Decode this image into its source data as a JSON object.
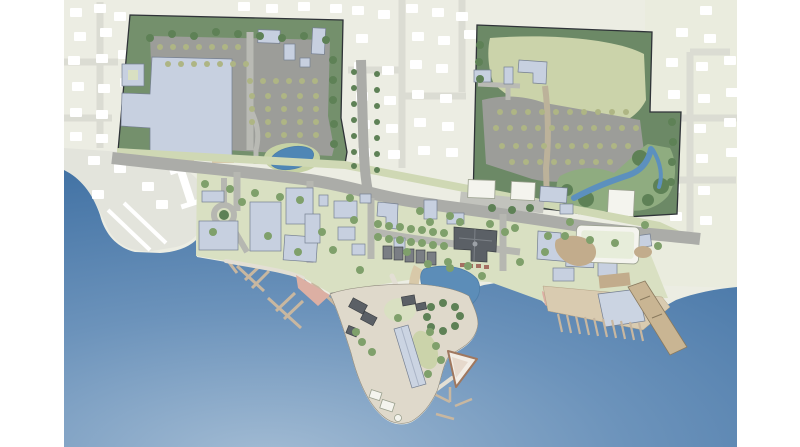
{
  "page": {
    "type": "Illustrated waterfront master-plan site map (aerial rendering)",
    "visible_text": "(none — the image contains no legible text, labels or numbers)"
  },
  "palette": {
    "page_bg": "#FFFFFF",
    "base_land": "#ECEDE3",
    "faded_tint_right": "#EAECDE",
    "faded_road": "#DBDCD3",
    "faded_house": "#FFFFFF",
    "faded_peninsula": "#E3E4DC",
    "water_light": "#A3BCD4",
    "water_mid": "#6C93BB",
    "water_deep": "#3A6CA0",
    "parcel_green": "#74906C",
    "parcel_green_right": "#6C8966",
    "field_olive": "#CBD3AA",
    "lawn": "#D9E0C2",
    "lawn_strip": "#CFD8B4",
    "knoll": "#C6D2A4",
    "parking": "#9C9D99",
    "parking_faint": "#C2C3BD",
    "road": "#ABACA8",
    "street": "#B6B7B1",
    "drive": "#B9BAB4",
    "path": "#E3DFD4",
    "tree_olive": "#AEB584",
    "tree_green": "#7FA06B",
    "tree_dark": "#5E8156",
    "bank_green": "#8FAC80",
    "building_blue": "#C7D0E0",
    "building_shed": "#CBD4E2",
    "building_white": "#F4F4EE",
    "building_dark": "#5B6066",
    "roof_gray": "#7A7E84",
    "arena_tint": "#E7EDDA",
    "tan": "#D8C9A9",
    "yard_tan": "#C2AC8C",
    "apron_tan": "#D9CBB0",
    "pier_tan": "#C9B593",
    "dock": "#C8B7A0",
    "breakwater": "#BFB6A8",
    "sand_pink": "#DCAFA3",
    "plaza_pink": "#D9A8A0",
    "stall_red": "#A56F62",
    "boat": "#6F7478",
    "pond_blue": "#5C8DB8",
    "stream_blue": "#5C90BE",
    "pond_left": "#4F86B5",
    "peninsula_ground": "#DFD9CB",
    "tan_road": "#BCB29A"
  },
  "map": {
    "description": "Aerial illustrative rendering of a coastal village master plan: two large redevelopment parcels with tree-lined parking lots to the north, a mixed-use village center along a sloping main street, a harbor with marina docks and boats, a waterfront park with pond and lawn knoll, a working boatyard peninsula with a sail-shaped pavilion, an east marina with finger docks and a long angled pier; surrounding existing neighborhoods are drawn faded.",
    "features": [
      {
        "name": "northwest-parcel",
        "desc": "Large parcel with big-box store, tree-lined parking rows and a small pond"
      },
      {
        "name": "northeast-parcel",
        "desc": "Parcel with fan-shaped tree-lined parking, open green field and stream corridor"
      },
      {
        "name": "village-center",
        "desc": "Mixed-use village blocks along the main street with lawns and street trees"
      },
      {
        "name": "market-hall",
        "desc": "Large dark cross-gabled civic/market building with stalls"
      },
      {
        "name": "harbor-basin",
        "desc": "Harbor basin with marina docks, moored boats and a breakwater"
      },
      {
        "name": "waterfront-park",
        "desc": "Waterfront park with kidney-shaped pond, tan promenade rim and tree-ringed lawn knoll"
      },
      {
        "name": "boatyard-peninsula",
        "desc": "Peninsula with long storage shed, dark work buildings and sail-shaped pavilion at the point"
      },
      {
        "name": "east-marina",
        "desc": "East marina apron with finger docks and a long pier angled into the bay"
      },
      {
        "name": "existing-neighborhoods",
        "desc": "Existing streets and houses shown faded at the edges of the plan"
      }
    ]
  }
}
